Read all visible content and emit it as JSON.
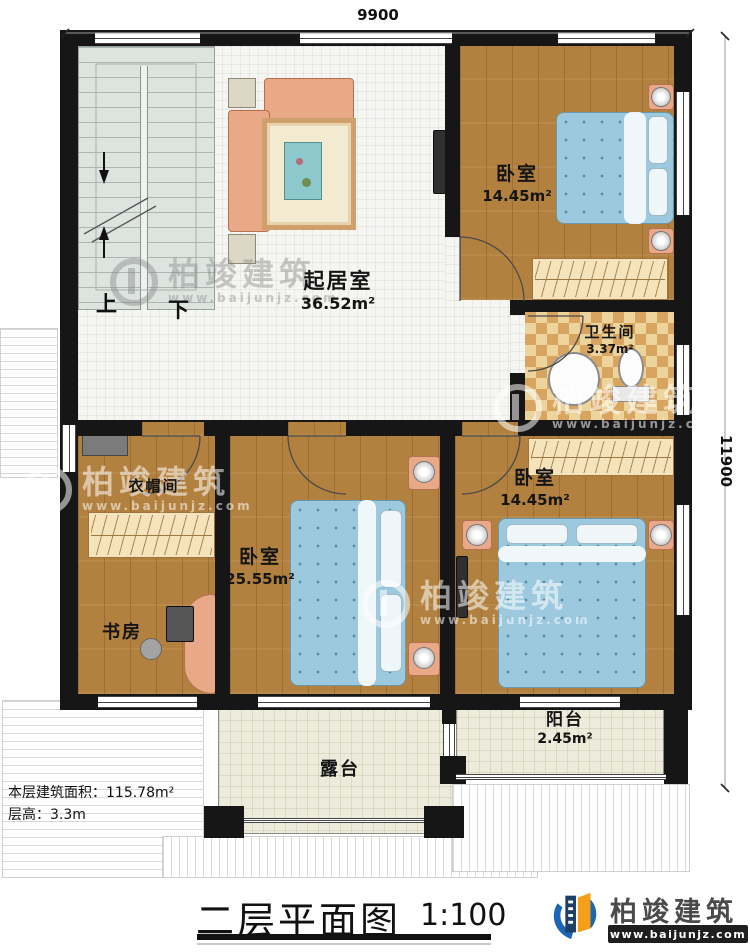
{
  "title": {
    "text": "二层平面图",
    "scale": "1:100"
  },
  "dimensions": {
    "width": "9900",
    "height": "11900"
  },
  "notes": {
    "area": "本层建筑面积：115.78m²",
    "floor_height": "层高：3.3m"
  },
  "rooms": {
    "living": {
      "name": "起居室",
      "area": "36.52m²"
    },
    "bedroom_a": {
      "name": "卧室",
      "area": "14.45m²"
    },
    "bathroom": {
      "name": "卫生间",
      "area": "3.37m²"
    },
    "bedroom_b": {
      "name": "卧室",
      "area": "14.45m²"
    },
    "bedroom_c": {
      "name": "卧室",
      "area": "25.55m²"
    },
    "cloakroom": {
      "name": "衣帽间"
    },
    "study": {
      "name": "书房"
    },
    "balcony": {
      "name": "阳台",
      "area": "2.45m²"
    },
    "terrace": {
      "name": "露台"
    }
  },
  "stairs": {
    "up": "上",
    "down": "下"
  },
  "brand": {
    "name": "柏竣建筑",
    "site": "www.baijunjz.com"
  },
  "colors": {
    "wall": "#161616",
    "wood": "#b2813f",
    "tile": "#f5f5f2",
    "stair": "#dde4e0",
    "bath_a": "#ecd49c",
    "bath_b": "#d7a55f",
    "bed": "#9cc9de",
    "furniture": "#e9a988",
    "closet": "#f4e3bb",
    "outdoor": "#edebdb",
    "logo_blue": "#1b67b3",
    "logo_orange": "#f6a01a"
  }
}
